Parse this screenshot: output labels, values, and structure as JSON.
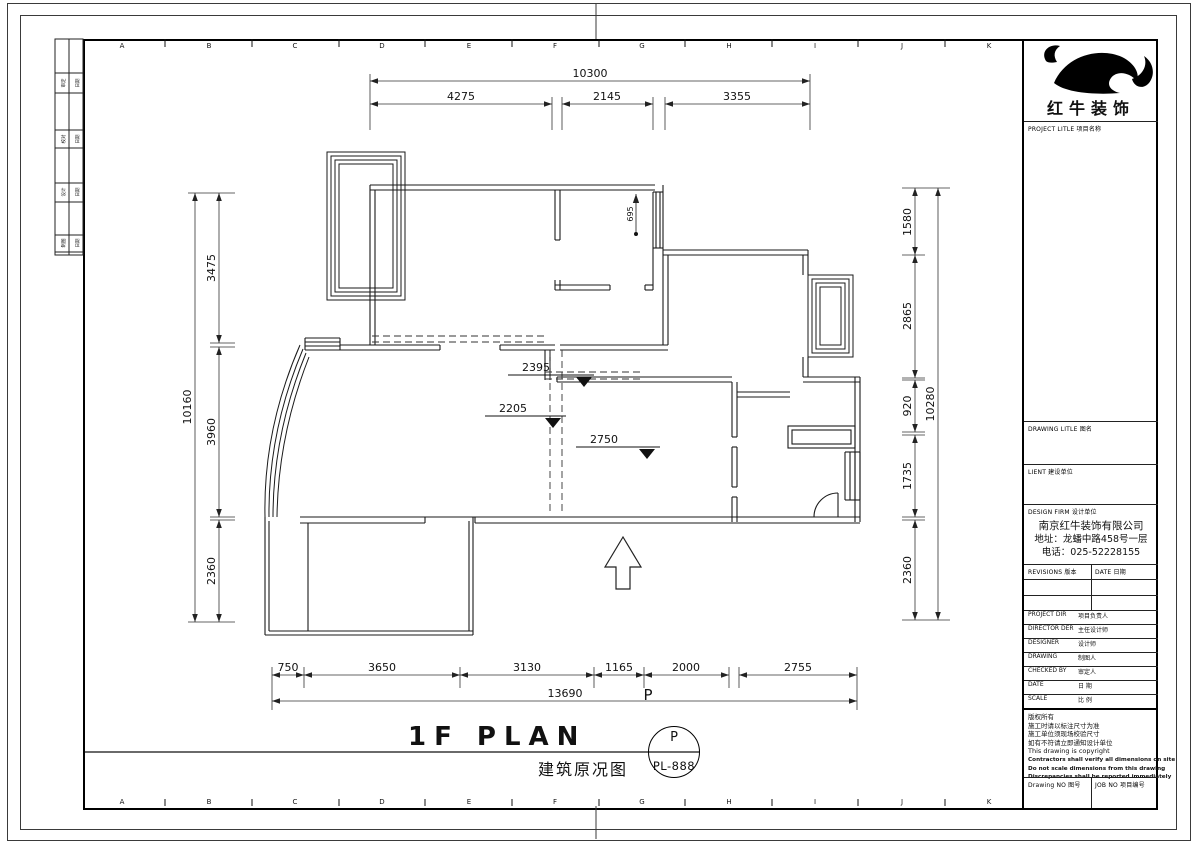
{
  "colors": {
    "ink": "#1a1a1a",
    "bg": "#ffffff"
  },
  "grid": {
    "letters": [
      "A",
      "B",
      "C",
      "D",
      "E",
      "F",
      "G",
      "H",
      "I",
      "J",
      "K"
    ]
  },
  "side_strip": {
    "rows": [
      {
        "c1": "审定",
        "c2": "日期"
      },
      {
        "c1": "校对",
        "c2": "日期"
      },
      {
        "c1": "设计",
        "c2": "日期"
      },
      {
        "c1": "制图",
        "c2": "日期"
      }
    ]
  },
  "dims": {
    "top_total": "10300",
    "top_seg": [
      "4275",
      "2145",
      "3355"
    ],
    "left_total": "10160",
    "left_seg": [
      "3475",
      "3960",
      "2360"
    ],
    "right_total": "10280",
    "right_seg": [
      "1580",
      "2865",
      "920",
      "1735",
      "2360"
    ],
    "bottom_total": "13690",
    "bottom_seg": [
      "750",
      "3650",
      "3130",
      "1165",
      "2000",
      "2755"
    ],
    "inner": {
      "d695": "695",
      "d2395": "2395",
      "d2205": "2205",
      "d2750": "2750"
    },
    "p_label": "P"
  },
  "title": {
    "main": "1F PLAN",
    "sub": "建筑原况图"
  },
  "stamp": {
    "top": "P",
    "no": "PL-888"
  },
  "tb": {
    "logo": "红牛装饰",
    "project_label": "PROJECT LITLE  项目名称",
    "drawing_label": "DRAWING LITLE  图名",
    "client_label": "LIENT  建设单位",
    "firm_label": "DESIGN FIRM  设计单位",
    "company": "南京红牛装饰有限公司",
    "addr": "地址：龙蟠中路458号一层",
    "tel": "电话：025-52228155",
    "revisions_label": "REVISIONS 版本",
    "date_col_label": "DATE 日期",
    "rows": [
      {
        "en": "PROJECT DIR",
        "cn": "项目负责人"
      },
      {
        "en": "DIRECTOR DER",
        "cn": "主任设计师"
      },
      {
        "en": "DESIGNER",
        "cn": "设计师"
      },
      {
        "en": "DRAWING",
        "cn": "制图人"
      },
      {
        "en": "CHECKED BY",
        "cn": "审定人"
      },
      {
        "en": "DATE",
        "cn": "日 期"
      },
      {
        "en": "SCALE",
        "cn": "比 例"
      }
    ],
    "notes": [
      "版权所有",
      "施工时请以标注尺寸为准",
      "施工单位须现场校验尺寸",
      "如有不符请立即通知设计单位",
      "This drawing is copyright",
      "Contractors shall verify all dimensions on site",
      "Do not scale dimensions from this drawing",
      "Discrepancies shall be reported immediately"
    ],
    "drawno_label": "Drawing NO  图号",
    "jobno_label": "JOB NO  项目编号"
  }
}
